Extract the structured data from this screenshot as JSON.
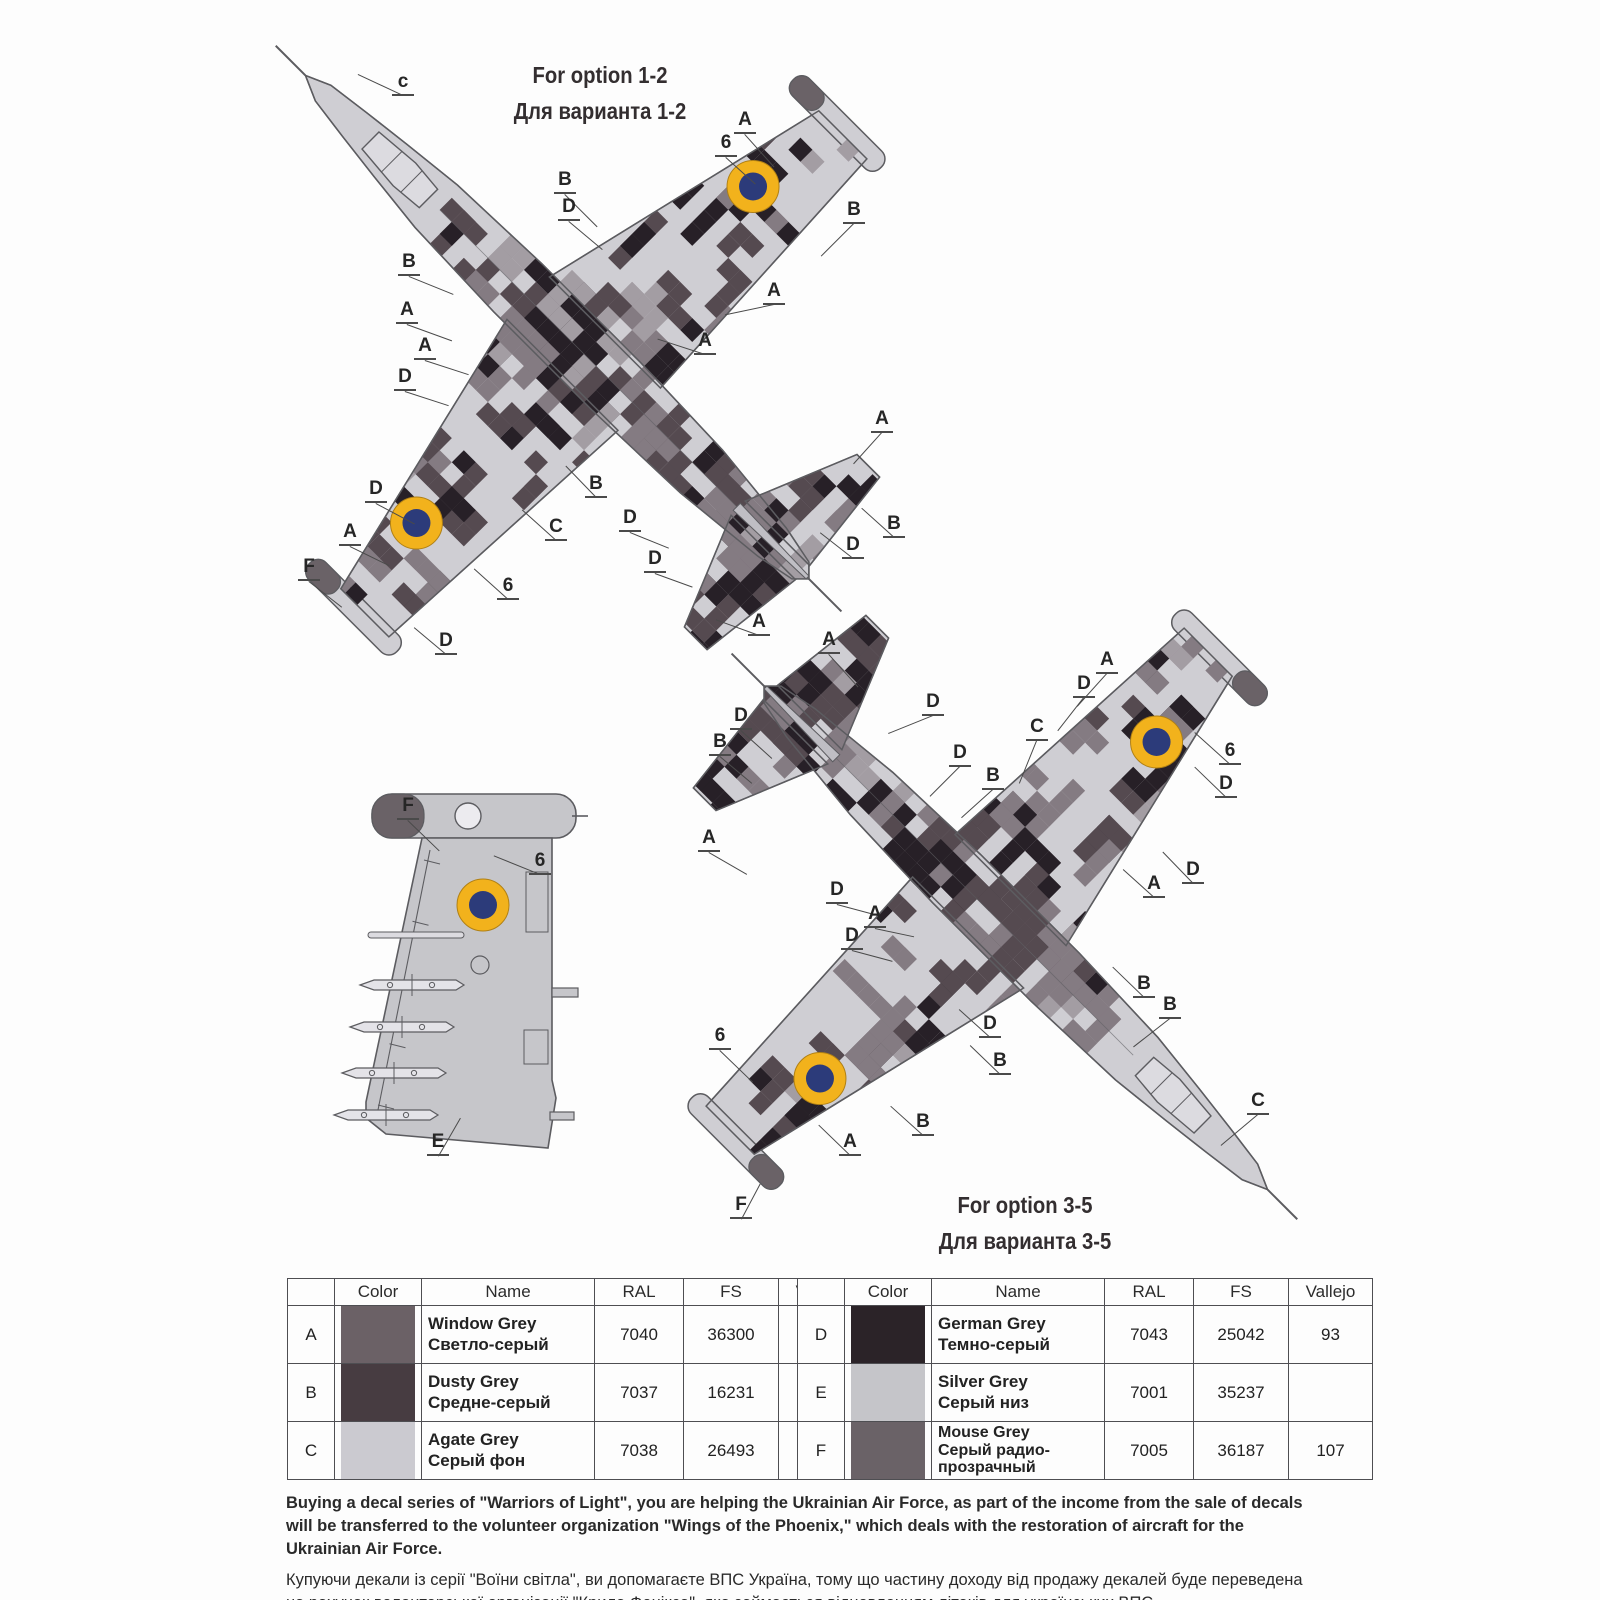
{
  "labels": {
    "option12_en": "For option 1-2",
    "option12_ru": "Для варианта 1-2",
    "option35_en": "For option 3-5",
    "option35_ru": "Для варианта 3-5"
  },
  "colors": {
    "base_agate": "#cfced3",
    "camo_window": "#847b82",
    "camo_dusty": "#554a50",
    "camo_german": "#272027",
    "camo_midlight": "#a39da3",
    "silver_underside": "#c6c6ca",
    "mouse_grey": "#6a6267",
    "outline": "#5c5c60",
    "canopy": "#dcdbe0",
    "roundel_yellow": "#f2b21c",
    "roundel_blue": "#2c3b7a",
    "leader": "#4a4a4a"
  },
  "diagrams": {
    "plane1": {
      "title": "Su-25 top view — camouflage option 1-2",
      "callouts": [
        {
          "t": "c",
          "x": 404,
          "y": 84,
          "a": 205,
          "l": 50
        },
        {
          "t": "A",
          "x": 746,
          "y": 122,
          "a": 48,
          "l": 44
        },
        {
          "t": "6",
          "x": 727,
          "y": 145,
          "a": 42,
          "l": 40
        },
        {
          "t": "B",
          "x": 566,
          "y": 182,
          "a": 45,
          "l": 46
        },
        {
          "t": "D",
          "x": 570,
          "y": 209,
          "a": 40,
          "l": 44
        },
        {
          "t": "B",
          "x": 855,
          "y": 212,
          "a": 135,
          "l": 46
        },
        {
          "t": "A",
          "x": 775,
          "y": 293,
          "a": 168,
          "l": 50
        },
        {
          "t": "B",
          "x": 410,
          "y": 264,
          "a": 22,
          "l": 48
        },
        {
          "t": "A",
          "x": 408,
          "y": 312,
          "a": 20,
          "l": 48
        },
        {
          "t": "A",
          "x": 426,
          "y": 348,
          "a": 18,
          "l": 46
        },
        {
          "t": "D",
          "x": 406,
          "y": 379,
          "a": 18,
          "l": 46
        },
        {
          "t": "A",
          "x": 706,
          "y": 343,
          "a": 198,
          "l": 50
        },
        {
          "t": "A",
          "x": 883,
          "y": 421,
          "a": 132,
          "l": 42
        },
        {
          "t": "D",
          "x": 631,
          "y": 520,
          "a": 22,
          "l": 42
        },
        {
          "t": "B",
          "x": 895,
          "y": 526,
          "a": 222,
          "l": 44
        },
        {
          "t": "D",
          "x": 854,
          "y": 547,
          "a": 218,
          "l": 42
        },
        {
          "t": "D",
          "x": 656,
          "y": 561,
          "a": 20,
          "l": 40
        },
        {
          "t": "D",
          "x": 377,
          "y": 491,
          "a": 28,
          "l": 44
        },
        {
          "t": "A",
          "x": 351,
          "y": 534,
          "a": 26,
          "l": 44
        },
        {
          "t": "C",
          "x": 557,
          "y": 529,
          "a": 222,
          "l": 46
        },
        {
          "t": "B",
          "x": 597,
          "y": 486,
          "a": 226,
          "l": 44
        },
        {
          "t": "F",
          "x": 310,
          "y": 569,
          "a": 38,
          "l": 42
        },
        {
          "t": "6",
          "x": 509,
          "y": 588,
          "a": 222,
          "l": 46
        },
        {
          "t": "D",
          "x": 447,
          "y": 643,
          "a": 220,
          "l": 42
        },
        {
          "t": "A",
          "x": 760,
          "y": 624,
          "a": 200,
          "l": 46
        }
      ]
    },
    "plane2": {
      "title": "Su-25 top view — camouflage option 3-5",
      "callouts": [
        {
          "t": "A",
          "x": 830,
          "y": 642,
          "a": 48,
          "l": 44
        },
        {
          "t": "D",
          "x": 934,
          "y": 704,
          "a": 158,
          "l": 48
        },
        {
          "t": "D",
          "x": 742,
          "y": 718,
          "a": 42,
          "l": 42
        },
        {
          "t": "B",
          "x": 721,
          "y": 744,
          "a": 40,
          "l": 42
        },
        {
          "t": "A",
          "x": 710,
          "y": 840,
          "a": 30,
          "l": 44
        },
        {
          "t": "D",
          "x": 961,
          "y": 755,
          "a": 135,
          "l": 42
        },
        {
          "t": "B",
          "x": 994,
          "y": 778,
          "a": 138,
          "l": 42
        },
        {
          "t": "D",
          "x": 838,
          "y": 892,
          "a": 15,
          "l": 42
        },
        {
          "t": "A",
          "x": 876,
          "y": 916,
          "a": 12,
          "l": 40
        },
        {
          "t": "D",
          "x": 853,
          "y": 938,
          "a": 15,
          "l": 42
        },
        {
          "t": "A",
          "x": 1108,
          "y": 662,
          "a": 132,
          "l": 44
        },
        {
          "t": "D",
          "x": 1085,
          "y": 686,
          "a": 128,
          "l": 42
        },
        {
          "t": "C",
          "x": 1038,
          "y": 729,
          "a": 112,
          "l": 46
        },
        {
          "t": "6",
          "x": 1231,
          "y": 753,
          "a": 222,
          "l": 48
        },
        {
          "t": "D",
          "x": 1227,
          "y": 786,
          "a": 224,
          "l": 44
        },
        {
          "t": "D",
          "x": 1194,
          "y": 872,
          "a": 226,
          "l": 44
        },
        {
          "t": "A",
          "x": 1155,
          "y": 886,
          "a": 222,
          "l": 42
        },
        {
          "t": "B",
          "x": 1145,
          "y": 986,
          "a": 224,
          "l": 44
        },
        {
          "t": "D",
          "x": 991,
          "y": 1026,
          "a": 222,
          "l": 42
        },
        {
          "t": "B",
          "x": 1001,
          "y": 1063,
          "a": 224,
          "l": 42
        },
        {
          "t": "B",
          "x": 1171,
          "y": 1007,
          "a": 142,
          "l": 46
        },
        {
          "t": "C",
          "x": 1259,
          "y": 1103,
          "a": 140,
          "l": 48
        },
        {
          "t": "6",
          "x": 721,
          "y": 1038,
          "a": 44,
          "l": 46
        },
        {
          "t": "B",
          "x": 924,
          "y": 1124,
          "a": 222,
          "l": 44
        },
        {
          "t": "A",
          "x": 851,
          "y": 1144,
          "a": 224,
          "l": 44
        },
        {
          "t": "F",
          "x": 742,
          "y": 1207,
          "a": 298,
          "l": 40
        }
      ]
    },
    "wing": {
      "title": "Wing underside view with stores",
      "callouts": [
        {
          "t": "F",
          "x": 409,
          "y": 808,
          "a": 44,
          "l": 44
        },
        {
          "t": "6",
          "x": 541,
          "y": 863,
          "a": 202,
          "l": 50
        },
        {
          "t": "E",
          "x": 439,
          "y": 1144,
          "a": 300,
          "l": 44
        }
      ]
    }
  },
  "table_left": {
    "headers": [
      "",
      "Color",
      "Name",
      "RAL",
      "FS",
      "Vallejo"
    ],
    "rows": [
      {
        "key": "A",
        "swatch": "#6b6166",
        "name_en": "Window Grey",
        "name_ru": "Светло-серый",
        "ral": "7040",
        "fs": "36300",
        "vallejo": ""
      },
      {
        "key": "B",
        "swatch": "#473c41",
        "name_en": "Dusty Grey",
        "name_ru": "Средне-серый",
        "ral": "7037",
        "fs": "16231",
        "vallejo": "155"
      },
      {
        "key": "C",
        "swatch": "#cbcad0",
        "name_en": "Agate Grey",
        "name_ru": "Серый фон",
        "ral": "7038",
        "fs": "26493",
        "vallejo": ""
      }
    ]
  },
  "table_right": {
    "headers": [
      "",
      "Color",
      "Name",
      "RAL",
      "FS",
      "Vallejo"
    ],
    "rows": [
      {
        "key": "D",
        "swatch": "#2b2328",
        "name_en": "German Grey",
        "name_ru": "Темно-серый",
        "ral": "7043",
        "fs": "25042",
        "vallejo": "93"
      },
      {
        "key": "E",
        "swatch": "#c5c5c9",
        "name_en": "Silver Grey",
        "name_ru": "Серый низ",
        "ral": "7001",
        "fs": "35237",
        "vallejo": ""
      },
      {
        "key": "F",
        "swatch": "#6a6267",
        "name_en": "Mouse Grey",
        "name_ru": "Серый радио-прозрачный",
        "ral": "7005",
        "fs": "36187",
        "vallejo": "107"
      }
    ]
  },
  "footer": {
    "en": "Buying a decal series of \"Warriors of Light\", you are helping the Ukrainian Air Force, as part of the income from the sale of decals will be transferred to the volunteer organization \"Wings of the Phoenix,\" which deals with the restoration of aircraft for the Ukrainian Air Force.",
    "ua": "Купуючи декали із серії \"Воїни світла\", ви допомагаєте ВПС Україна, тому що частину доходу від продажу декалей буде переведена на рахунок волонтерської організації \"Крила Фенікса\", яка займається відновленням літаків для українських ВПС."
  }
}
